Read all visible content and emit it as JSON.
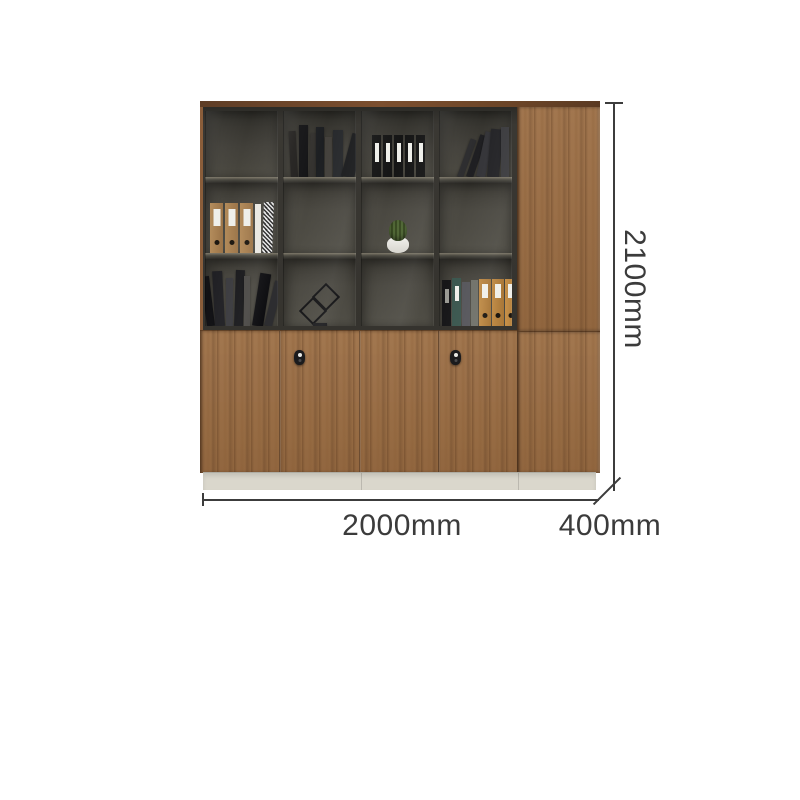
{
  "labels": {
    "height": "2100mm",
    "width": "2000mm",
    "depth": "400mm"
  },
  "palette": {
    "wood": "#9c6e44",
    "wood_top_strip": "#6a4427",
    "shelf_interior": "#4b4942",
    "frame": "#35332e",
    "plinth": "#dad7cc",
    "annotation": "#3b3b3b",
    "background": "#ffffff",
    "kraft_binder": "#b28a59",
    "orange_binder": "#bf8a45",
    "teal_binder": "#3a564e"
  },
  "cabinet": {
    "description": "walnut office wall cabinet: 4-bay glass display hutch over locking doors, plus 400mm side cabinet",
    "shelf_contents": {
      "row1": [
        "empty",
        "stack of dark books",
        "five black file binders with white labels",
        "dark books leaning right"
      ],
      "row2": [
        "three kraft lever-arch binders, white book, checkered book",
        "empty",
        "cactus in white pot",
        "empty"
      ],
      "row3": [
        "leaning dark books",
        "black wire cube sculpture",
        "empty",
        "dark and kraft lever-arch binders"
      ]
    },
    "hardware": [
      "keyhole lock on second door",
      "keyhole lock on fourth door"
    ]
  }
}
